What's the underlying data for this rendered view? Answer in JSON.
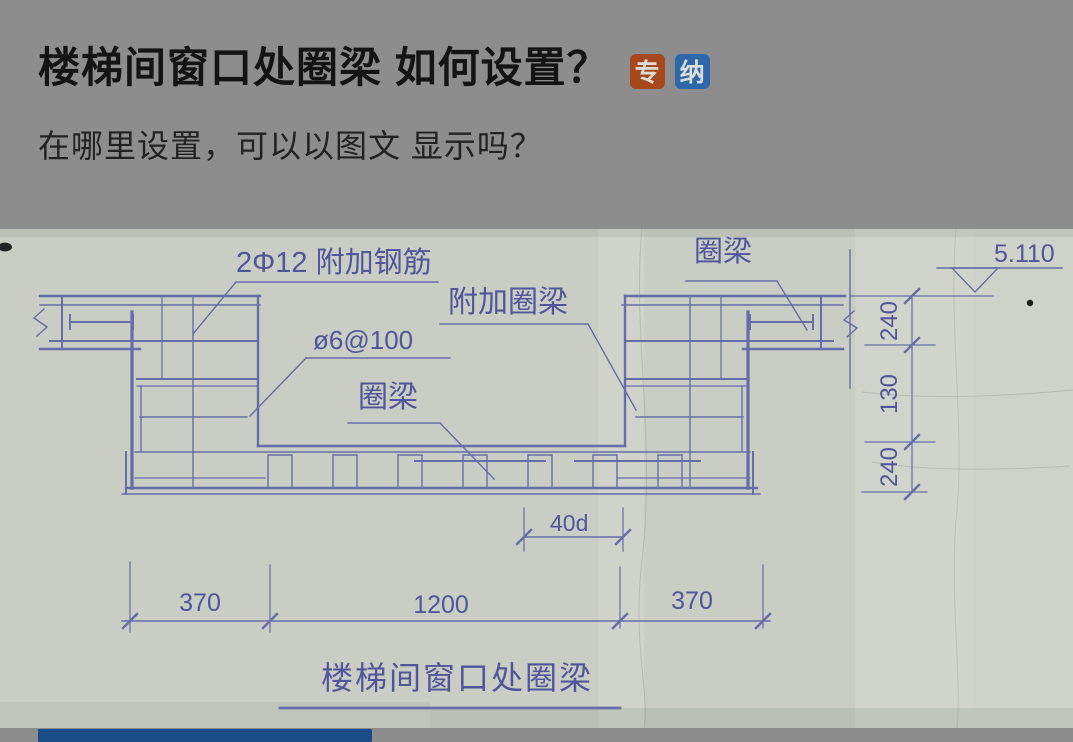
{
  "header": {
    "title": "楼梯间窗口处圈梁 如何设置？",
    "subtitle": "在哪里设置，可以以图文 显示吗？",
    "badges": [
      {
        "label": "专",
        "color": "#a7481c"
      },
      {
        "label": "纳",
        "color": "#2e68ab"
      }
    ]
  },
  "drawing": {
    "paper_color": "#c9cdc3",
    "ink_color": "#686ca8",
    "text_color": "#51559c",
    "labels": {
      "additional_rebar": "2Φ12 附加钢筋",
      "additional_ring_beam": "附加圈梁",
      "stirrup_spec": "ø6@100",
      "ring_beam_mid": "圈梁",
      "ring_beam_top": "圈梁",
      "elevation": "5.110",
      "anchorage_length": "40d"
    },
    "dimensions": {
      "horizontal": [
        "370",
        "1200",
        "370"
      ],
      "vertical_top_to_bottom": [
        "240",
        "130",
        "240"
      ]
    },
    "caption": "楼梯间窗口处圈梁"
  },
  "footer": {
    "bar_color": "#1a4c85"
  }
}
